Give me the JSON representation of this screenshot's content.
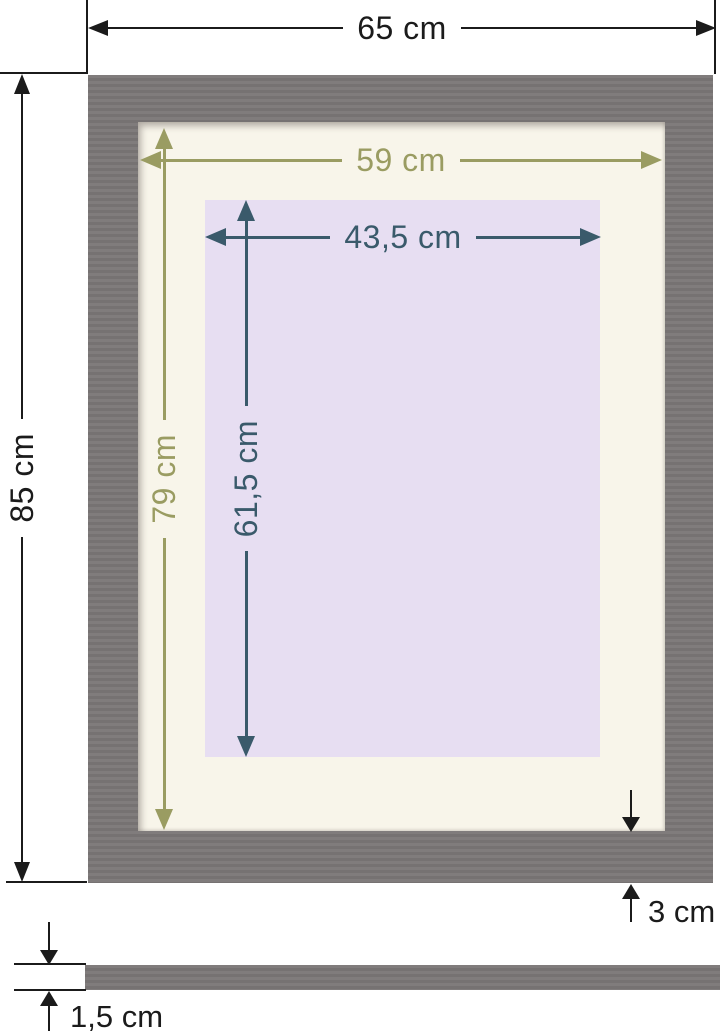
{
  "figure": {
    "kind": "picture-frame-dimension-diagram",
    "colors": {
      "frame": "#7b7777",
      "mat": "#f8f5ea",
      "opening": "#e7def2",
      "outer_dim": "#1b1b1b",
      "mat_dim": "#9a9c62",
      "opening_dim": "#3a5a6b"
    },
    "dimensions": {
      "outer_width": "65 cm",
      "outer_height": "85 cm",
      "mat_width": "59 cm",
      "mat_height": "79 cm",
      "opening_width": "43,5 cm",
      "opening_height": "61,5 cm",
      "frame_face": "3 cm",
      "frame_depth": "1,5 cm"
    }
  }
}
